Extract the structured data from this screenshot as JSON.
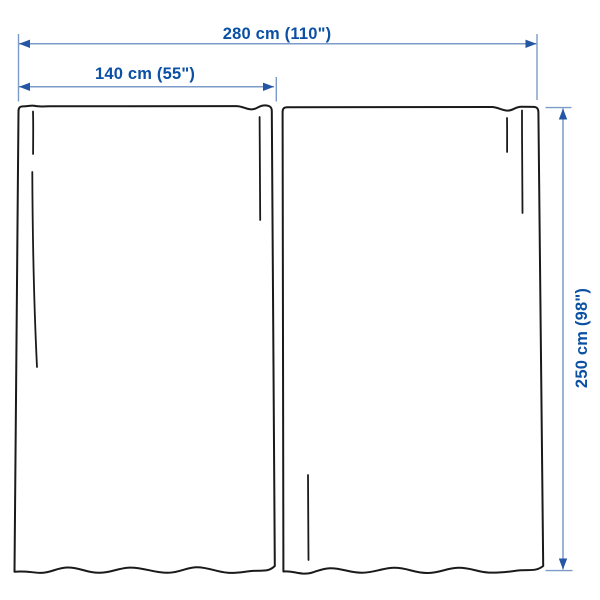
{
  "diagram": {
    "type": "product-dimension-diagram",
    "panels_drawn": 2,
    "labels": {
      "total_width": "280 cm (110\")",
      "panel_width": "140 cm (55\")",
      "height": "250 cm (98\")"
    },
    "colors": {
      "dimension_text": "#0b50a5",
      "dimension_line": "#7d9bc8",
      "arrowhead": "#2456a4",
      "outline": "#1a1a1a",
      "background": "#ffffff"
    }
  }
}
